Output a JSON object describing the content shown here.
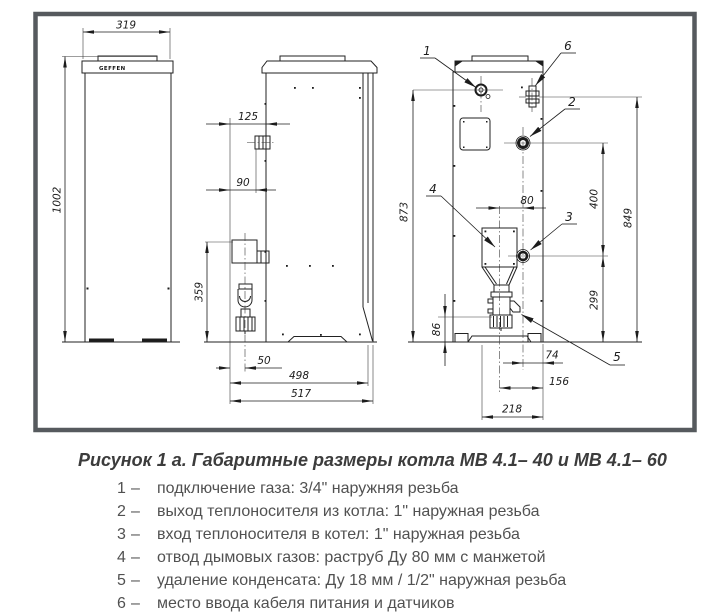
{
  "figure": {
    "caption": "Рисунок 1 а. Габаритные размеры котла МВ 4.1– 40 и МВ 4.1– 60",
    "dash": "–",
    "legend": [
      {
        "num": "1",
        "text": "подключение газа: 3/4\" наружняя резьба"
      },
      {
        "num": "2",
        "text": "выход теплоносителя из котла: 1\" наружная резьба"
      },
      {
        "num": "3",
        "text": "вход теплоносителя в котел: 1\" наружная резьба"
      },
      {
        "num": "4",
        "text": "отвод дымовых газов: раструб Ду 80 мм с манжетой"
      },
      {
        "num": "5",
        "text": "удаление конденсата: Ду 18 мм / 1/2\" наружная резьба"
      },
      {
        "num": "6",
        "text": "место ввода кабеля питания и датчиков"
      }
    ]
  },
  "drawing": {
    "brand": "GEFFEN",
    "dims": {
      "front_width": "319",
      "front_height": "1002",
      "side_gas_depth": "125",
      "side_pipe_depth": "90",
      "side_flue_height": "359",
      "side_trap_depth": "50",
      "side_depth_inner": "498",
      "side_depth_total": "517",
      "rear_gas_height": "873",
      "rear_flue_offset": "80",
      "rear_supply_return_gap": "400",
      "rear_gland_height": "849",
      "rear_return_height": "299",
      "rear_drain_height": "86",
      "rear_drain_offset": "74",
      "rear_flue_to_edge": "156",
      "rear_gas_to_edge": "218"
    },
    "callouts": {
      "c1": "1",
      "c2": "2",
      "c3": "3",
      "c4": "4",
      "c5": "5",
      "c6": "6"
    }
  }
}
